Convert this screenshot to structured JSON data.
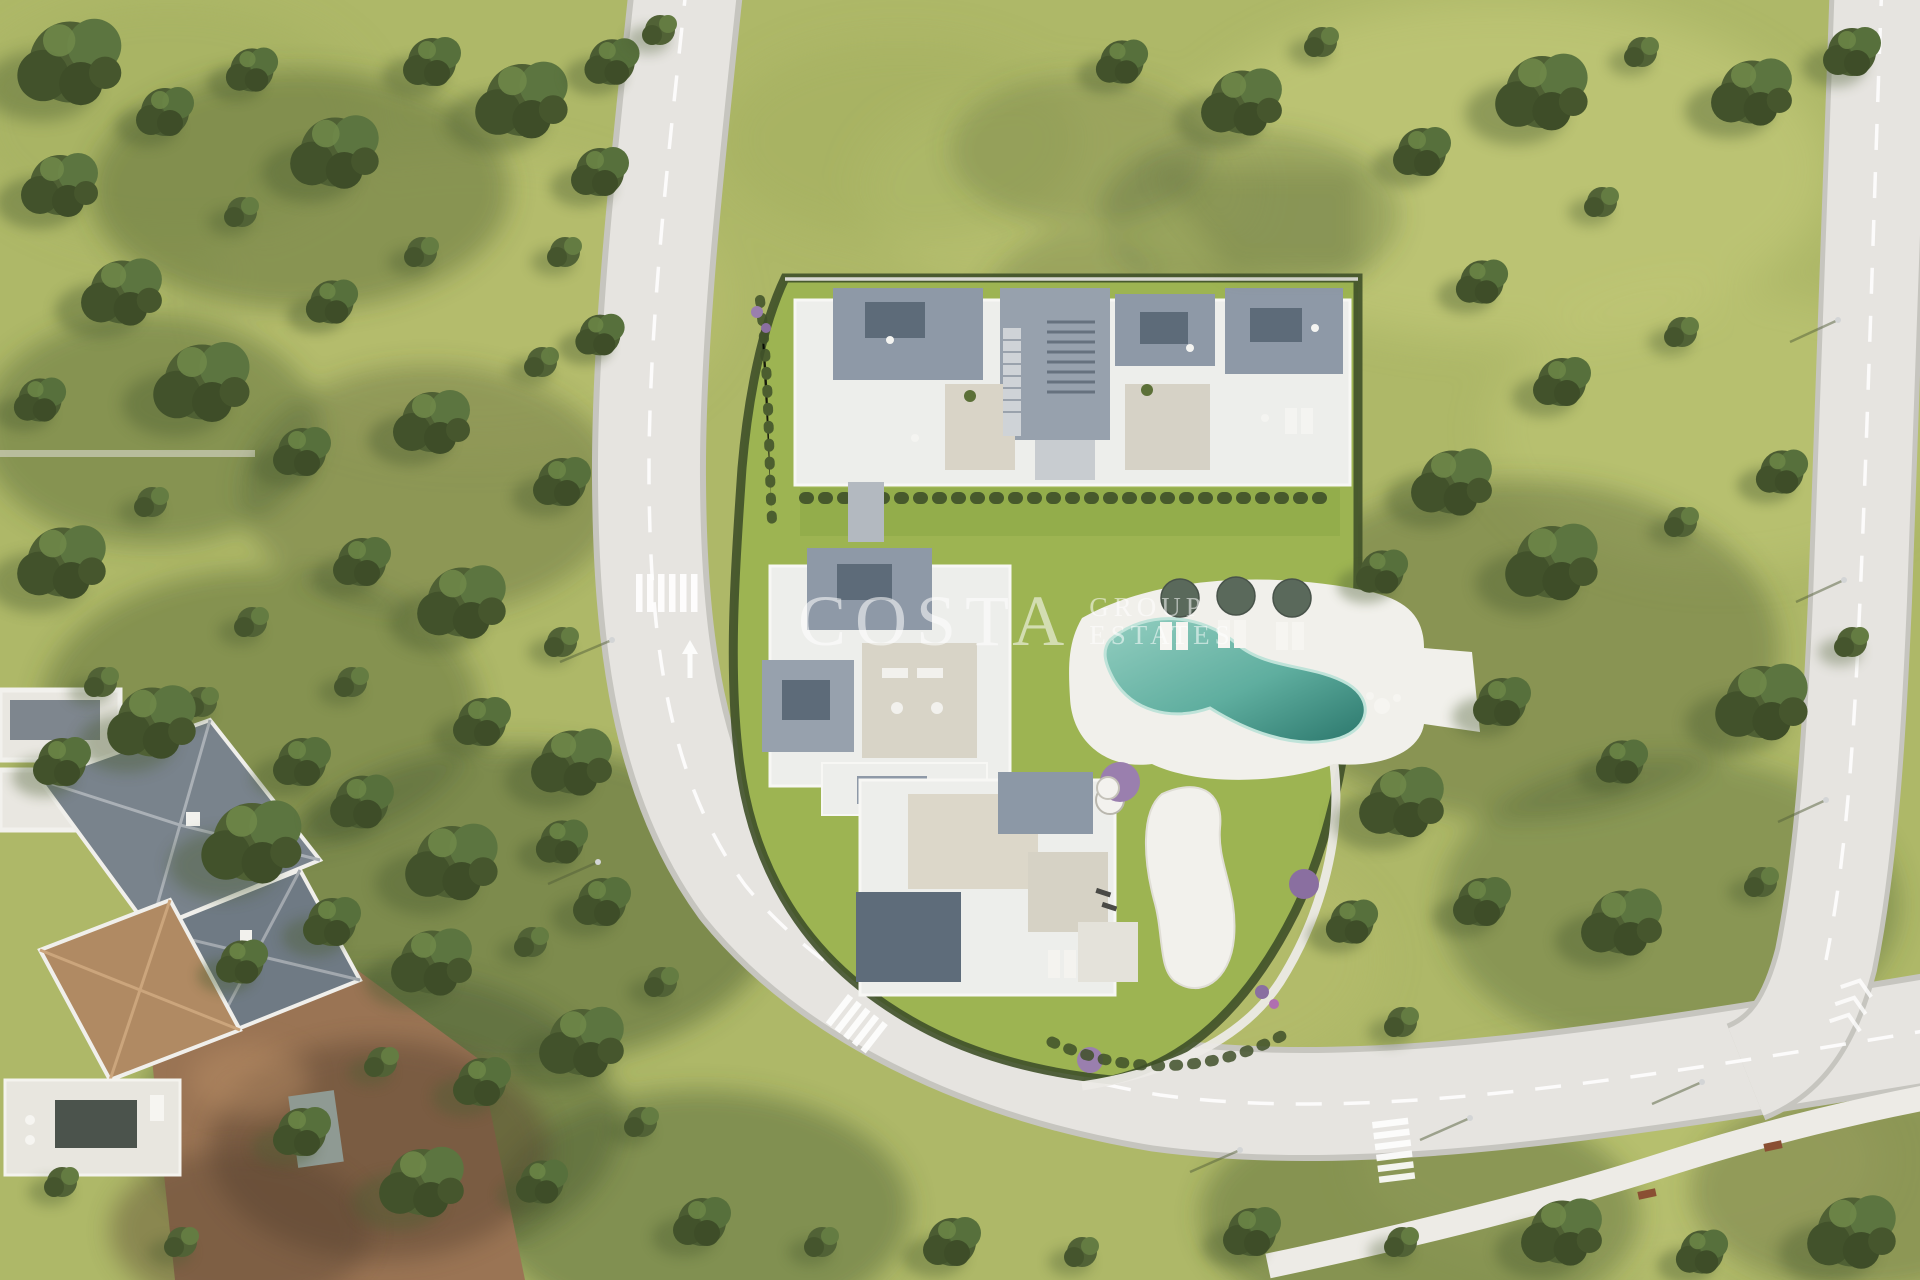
{
  "watermark": {
    "brand": "COSTA",
    "suffix_line1": "GROUP",
    "suffix_line2": "ESTATES"
  },
  "colors": {
    "grass_base": "#aeb868",
    "grass_light": "#c9cf7e",
    "grass_dark": "#7d8c4c",
    "plot_lawn": "#9db452",
    "tree_dark": "#45562f",
    "tree_mid": "#5c7038",
    "shadow_olive": "#4c5d33",
    "road": "#e6e4e0",
    "road_edge": "#c6c5bf",
    "footpath": "#edebe6",
    "marking_white": "#ffffff",
    "building_white": "#edeeeb",
    "roof_gray": "#8e99a7",
    "roof_slate": "#5d6b79",
    "terrace_beige": "#d9d4c7",
    "pool_shallow": "#93cec0",
    "pool_deep": "#2b776c",
    "deck_white": "#f1f0eb",
    "hedge_green": "#3f5029",
    "dirt_brown": "#9a7454",
    "villa_roof_slate": "#79838c",
    "villa_roof_terracotta": "#b08a63",
    "bench_brown": "#8a4f33",
    "flower_purple": "#9a7fae",
    "watermark_white": "#ffffff"
  }
}
